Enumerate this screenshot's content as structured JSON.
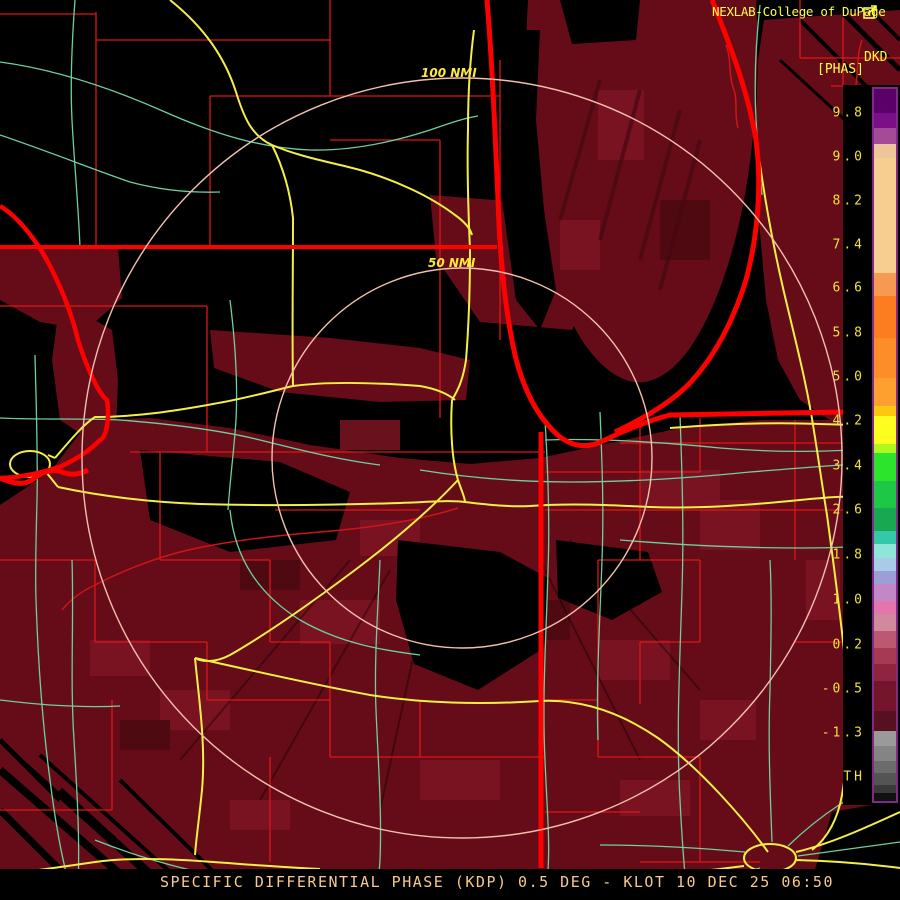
{
  "header": {
    "title": "NEXLAB-College of DuPage"
  },
  "colorbar": {
    "product_label_line1": "DKD",
    "product_label_line2": "[PHAS]",
    "border_color": "#7d2b86",
    "tick_color": "#f0e23c",
    "ticks": [
      {
        "label": "9.8",
        "y": 28
      },
      {
        "label": "9.0",
        "y": 72
      },
      {
        "label": "8.2",
        "y": 116
      },
      {
        "label": "7.4",
        "y": 160
      },
      {
        "label": "6.6",
        "y": 203
      },
      {
        "label": "5.8",
        "y": 248
      },
      {
        "label": "5.0",
        "y": 292
      },
      {
        "label": "4.2",
        "y": 336
      },
      {
        "label": "3.4",
        "y": 381
      },
      {
        "label": "2.6",
        "y": 425
      },
      {
        "label": "1.8",
        "y": 470
      },
      {
        "label": "1.0",
        "y": 515
      },
      {
        "label": "0.2",
        "y": 560
      },
      {
        "label": "-0.5",
        "y": 604
      },
      {
        "label": "-1.3",
        "y": 648
      },
      {
        "label": "TH",
        "y": 692
      }
    ],
    "segments": [
      {
        "c": "#5c0069",
        "h": 24
      },
      {
        "c": "#7b0f87",
        "h": 15
      },
      {
        "c": "#a34b97",
        "h": 16
      },
      {
        "c": "#eec49a",
        "h": 14
      },
      {
        "c": "#f7cd90",
        "h": 115
      },
      {
        "c": "#f59a50",
        "h": 23
      },
      {
        "c": "#fb7d20",
        "h": 42
      },
      {
        "c": "#fd8d28",
        "h": 40
      },
      {
        "c": "#fda030",
        "h": 28
      },
      {
        "c": "#fdc710",
        "h": 10
      },
      {
        "c": "#fdfd20",
        "h": 28
      },
      {
        "c": "#aef81e",
        "h": 9
      },
      {
        "c": "#2ce42c",
        "h": 28
      },
      {
        "c": "#1ec846",
        "h": 27
      },
      {
        "c": "#19a852",
        "h": 23
      },
      {
        "c": "#35c8a8",
        "h": 13
      },
      {
        "c": "#8fe5da",
        "h": 14
      },
      {
        "c": "#a9cbe8",
        "h": 13
      },
      {
        "c": "#9b9fd6",
        "h": 13
      },
      {
        "c": "#c287c4",
        "h": 17
      },
      {
        "c": "#e377ad",
        "h": 13
      },
      {
        "c": "#d2899b",
        "h": 17
      },
      {
        "c": "#bc5872",
        "h": 17
      },
      {
        "c": "#a63a55",
        "h": 16
      },
      {
        "c": "#8f2440",
        "h": 17
      },
      {
        "c": "#74152c",
        "h": 30
      },
      {
        "c": "#57101f",
        "h": 20
      },
      {
        "c": "#9a9a9a",
        "h": 15
      },
      {
        "c": "#848484",
        "h": 15
      },
      {
        "c": "#6c6c6c",
        "h": 12
      },
      {
        "c": "#545454",
        "h": 12
      },
      {
        "c": "#3a3a3a",
        "h": 8
      },
      {
        "c": "#111111",
        "h": 10
      }
    ]
  },
  "map": {
    "range_rings": [
      {
        "label": "50 NMI",
        "radius_px": 190
      },
      {
        "label": "100 NMI",
        "radius_px": 380
      }
    ],
    "ring_center": {
      "x": 462,
      "y": 458
    },
    "colors": {
      "background": "#000000",
      "echo": "#650c18",
      "echo_dark": "#4f0911",
      "echo_light": "#7c1423",
      "county": "#dd1616",
      "state_border": "#ff0000",
      "road_primary": "#f3ef47",
      "road_secondary": "#6fcf9f",
      "range_ring": "#f2c0ae",
      "river_thin": "#cc1616",
      "label_yellow": "#ffe93e"
    }
  },
  "status_bar": {
    "text": "SPECIFIC DIFFERENTIAL PHASE (KDP) 0.5 DEG - KLOT 10 DEC 25 06:50"
  }
}
